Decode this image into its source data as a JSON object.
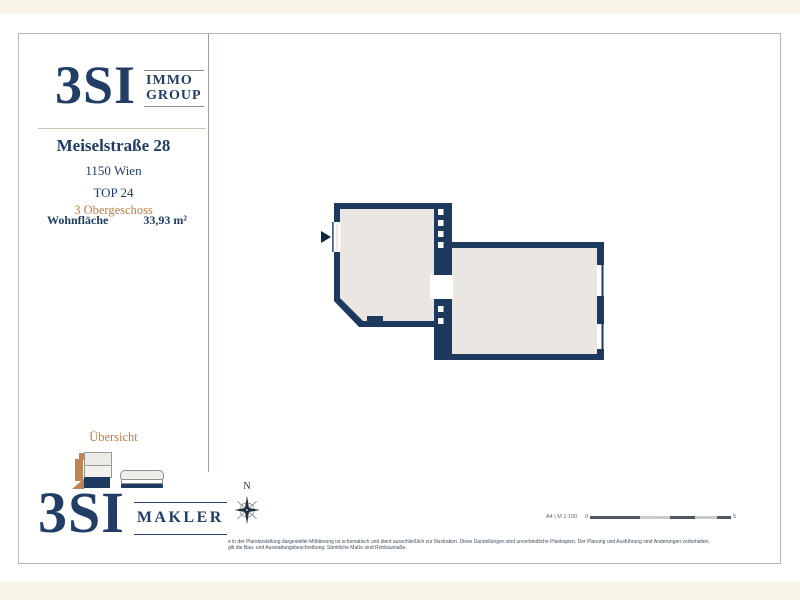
{
  "sidebar": {
    "logo_top": {
      "brand": "3SI",
      "line1": "IMMO",
      "line2": "GROUP"
    },
    "address": "Meiselstraße 28",
    "city": "1150 Wien",
    "unit": "TOP 24",
    "floor": "3 Obergeschoss",
    "area": {
      "label": "Wohnfläche",
      "value": "33,93 m²"
    },
    "overview_label": "Übersicht",
    "logo_bottom": {
      "brand": "3SI",
      "suffix": "MAKLER"
    }
  },
  "plan": {
    "compass_label": "N",
    "scale_caption": "A4 | M 1:100",
    "scale_min": "0",
    "scale_max": "5",
    "colors": {
      "wall": "#1d3a5e",
      "floor": "#eae6e1",
      "accent": "#c07c3f"
    }
  },
  "footer": {
    "disclaimer_line1": "e in der Plandarstellung dargestellte Möblierung ist schematisch und dient ausschließlich zur Illustration. Diese Darstellungen sind unverbindliche Plankopien. Der Planung und Ausführung sind Änderungen vorbehalten.",
    "disclaimer_line2": "gilt die Bau- und Ausstattungsbeschreibung. Sämtliche Maße sind Rohbaumaße."
  }
}
